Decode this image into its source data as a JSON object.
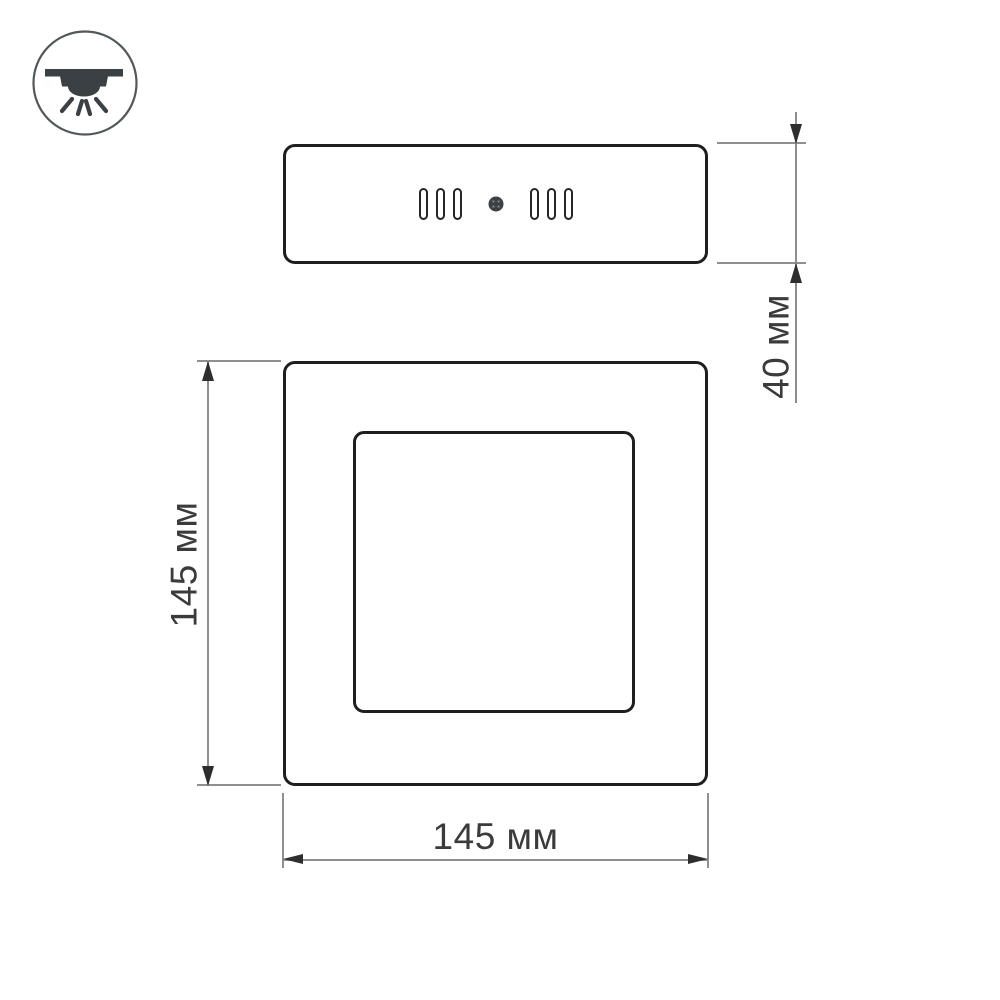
{
  "drawing": {
    "title_hint": "surface-mounted square LED panel dimensional drawing",
    "labels": {
      "height": "40 мм",
      "side": "145 мм",
      "width": "145 мм"
    },
    "icon": "surface-mounted-downlight",
    "colors": {
      "outline": "#1f1f1f",
      "dimension_line": "#8f8f8f",
      "arrowhead": "#2e2e2e",
      "label_text": "#3b3b3b",
      "icon_fill": "#3a4043",
      "background": "#ffffff"
    }
  }
}
